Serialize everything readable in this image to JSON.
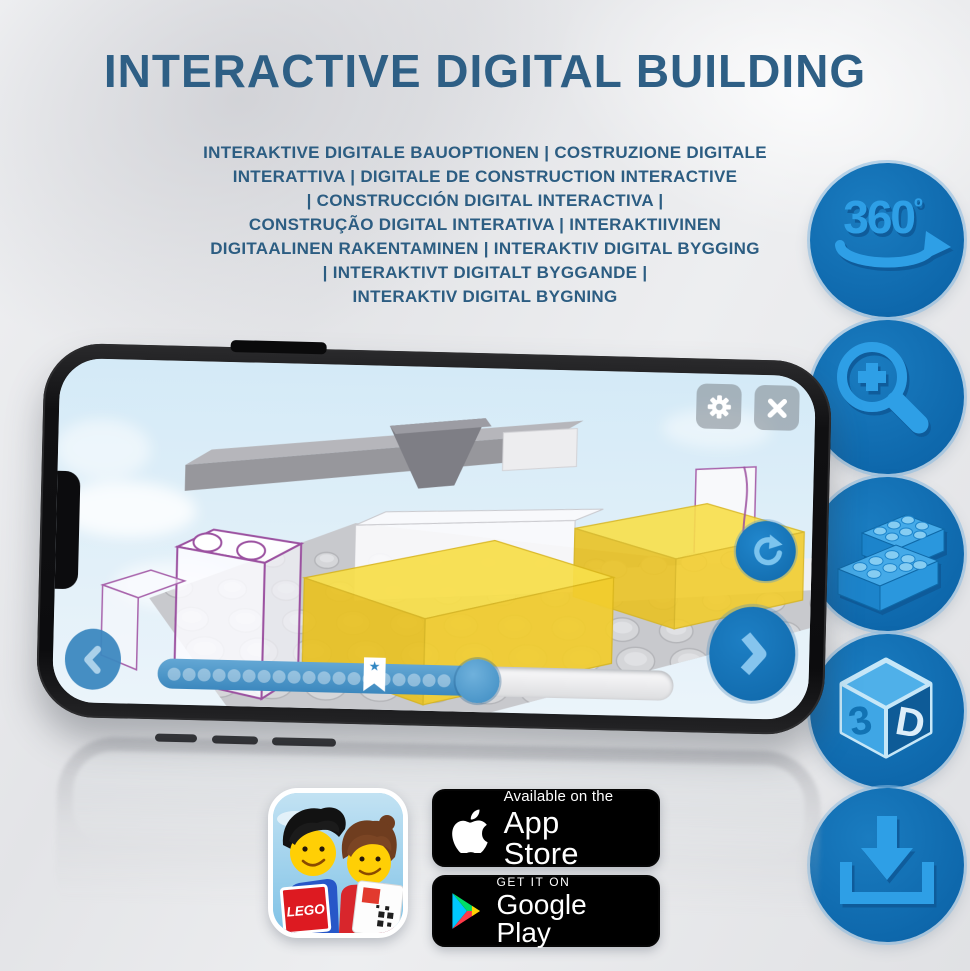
{
  "title": "INTERACTIVE DIGITAL BUILDING",
  "subtitle": {
    "lines": [
      "INTERAKTIVE DIGITALE BAUOPTIONEN | COSTRUZIONE DIGITALE",
      "INTERATTIVA | DIGITALE DE CONSTRUCTION INTERACTIVE",
      "| CONSTRUCCIÓN DIGITAL INTERACTIVA |",
      "CONSTRUÇÃO DIGITAL INTERATIVA | INTERAKTIIVINEN",
      "DIGITAALINEN RAKENTAMINEN | INTERAKTIV DIGITAL BYGGING",
      "| INTERAKTIVT DIGITALT BYGGANDE |",
      "INTERAKTIV DIGITAL BYGNING"
    ]
  },
  "features": {
    "items": [
      {
        "name": "360-rotation",
        "number": "360",
        "degree": "º"
      },
      {
        "name": "zoom-in"
      },
      {
        "name": "brick-building"
      },
      {
        "name": "3d-view",
        "left": "3",
        "right": "D"
      },
      {
        "name": "download"
      }
    ]
  },
  "phone_app": {
    "bookmark_star": "★",
    "progress": {
      "fill_percent": 62,
      "star_percent": 42,
      "step_dots": 19
    }
  },
  "app_icon": {
    "logo_text": "LEGO"
  },
  "store": {
    "app_store": {
      "tagline": "Available on the",
      "name": "App Store"
    },
    "google_play": {
      "tagline": "GET IT ON",
      "name": "Google Play"
    }
  },
  "colors": {
    "title_blue": "#2e5f85",
    "icon_circle_blue": "#0f6fb4",
    "icon_glyph_blue": "#2f9fe6",
    "ui_blue": "#1b79bd",
    "brick_yellow": "#f3d23a",
    "ghost_outline_purple": "#9b51a0"
  }
}
